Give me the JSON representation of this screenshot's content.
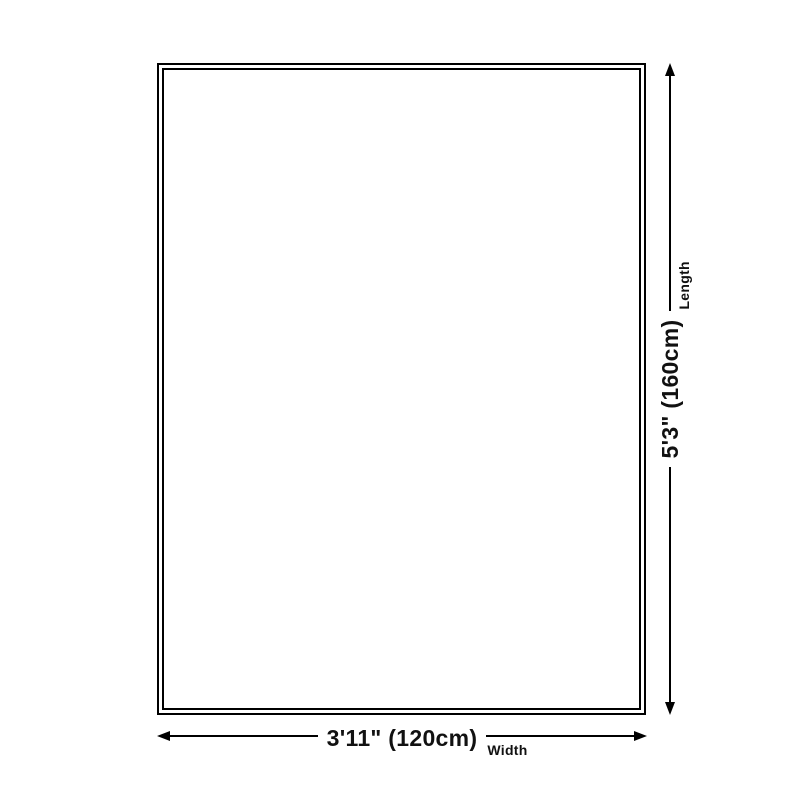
{
  "diagram": {
    "width_dimension": {
      "value": "3'11\" (120cm)",
      "label": "Width"
    },
    "length_dimension": {
      "value": "5'3\" (160cm)",
      "label": "Length"
    },
    "colors": {
      "line": "#000000",
      "background": "#ffffff",
      "text": "#111111"
    }
  }
}
